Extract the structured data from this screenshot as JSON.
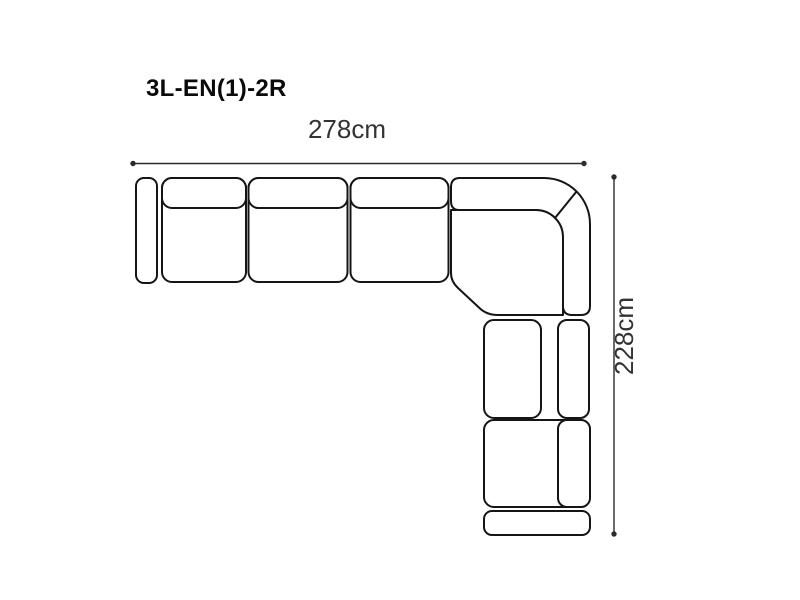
{
  "diagram": {
    "product_code": "3L-EN(1)-2R",
    "dimensions": {
      "width_label": "278cm",
      "height_label": "228cm"
    },
    "colors": {
      "background": "#ffffff",
      "outline": "#151515",
      "dimension_line": "#2b2b2b",
      "dimension_text": "#333333",
      "title_text": "#0a0a0a"
    },
    "parts": [
      "left-armrest",
      "seat-module-1",
      "seat-module-2",
      "seat-module-3",
      "corner-module",
      "right-seat-module-1",
      "right-seat-module-2",
      "front-armrest"
    ]
  }
}
